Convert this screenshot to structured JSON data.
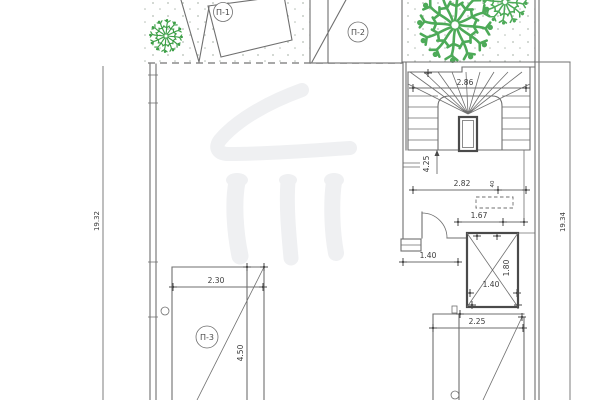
{
  "labels": {
    "p1": "П-1",
    "p2": "П-2",
    "p3": "П-3"
  },
  "dims": {
    "stair_width": "2.86",
    "stair_drop": "4.25",
    "corridor_width": "2.82",
    "offset_40": "40",
    "clear_167": "1.67",
    "lobby_140": "1.40",
    "shaft_140": "1.40",
    "shaft_180": "1.80",
    "ramp_225": "2.25",
    "p3_width": "2.30",
    "p3_height": "4.50",
    "total_left": "19.32",
    "total_right": "19.34"
  },
  "colors": {
    "line": "#6f6f6f",
    "dark": "#4a4a4a",
    "dash": "#8b8b8b",
    "tree": "#44a24e",
    "stipple": "#b4bdb4",
    "watermark": "#eff0f2"
  }
}
